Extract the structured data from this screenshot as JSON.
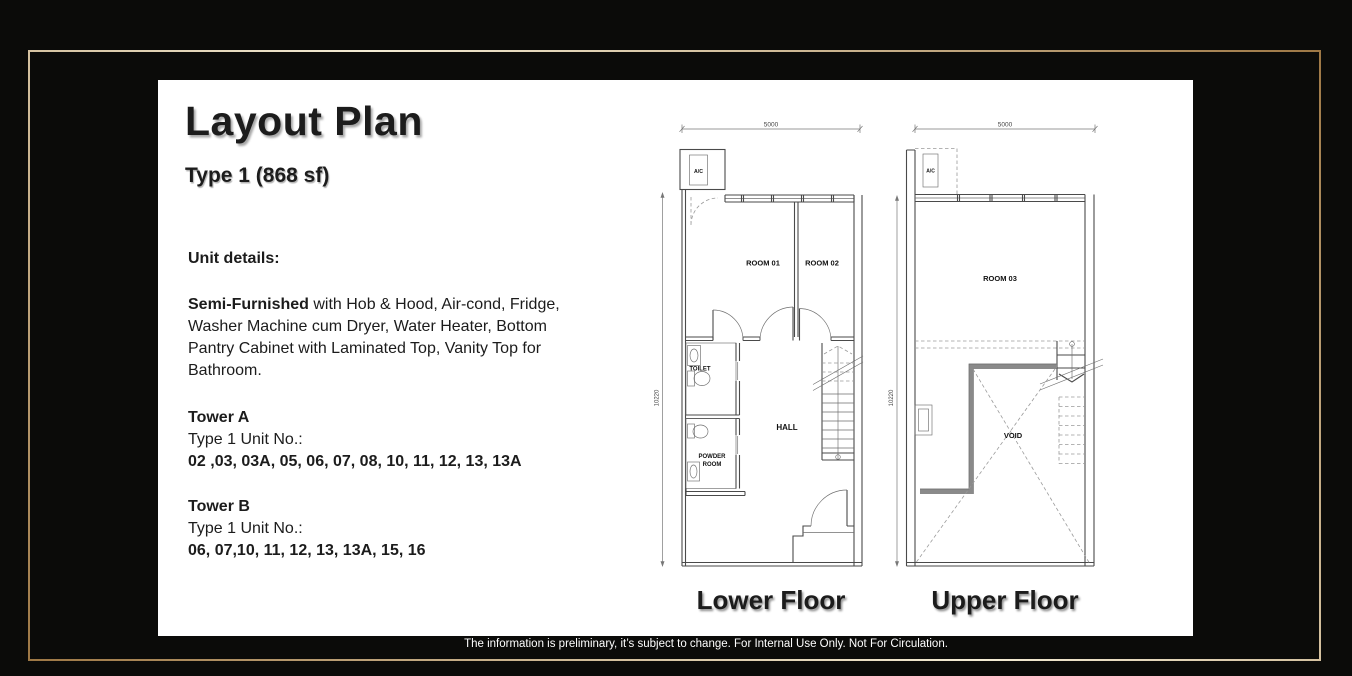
{
  "slide": {
    "title": "Layout Plan",
    "subtitle": "Type 1 (868 sf)",
    "unit_details_heading": "Unit details:",
    "details": {
      "lead": "Semi-Furnished",
      "rest": " with Hob & Hood, Air-cond, Fridge,\nWasher Machine cum Dryer, Water Heater, Bottom\nPantry Cabinet with Laminated Top, Vanity Top for\nBathroom."
    },
    "towers": [
      {
        "name": "Tower A",
        "type_label": "Type 1 Unit No.:",
        "units": "02 ,03, 03A, 05, 06, 07, 08, 10, 11, 12, 13, 13A"
      },
      {
        "name": "Tower B",
        "type_label": "Type 1 Unit No.:",
        "units": "06, 07,10, 11, 12, 13, 13A, 15, 16"
      }
    ],
    "plans": {
      "lower": {
        "caption": "Lower Floor",
        "dim_width": "5000",
        "dim_height": "10220",
        "ac": "A/C",
        "room01": "ROOM 01",
        "room02": "ROOM 02",
        "toilet": "TOILET",
        "hall": "HALL",
        "powder_line1": "POWDER",
        "powder_line2": "ROOM"
      },
      "upper": {
        "caption": "Upper Floor",
        "dim_width": "5000",
        "dim_height": "10220",
        "ac": "A/C",
        "room03": "ROOM 03",
        "void": "VOID"
      }
    },
    "disclaimer": "The information is preliminary, it’s subject to change. For Internal Use Only. Not For Circulation."
  },
  "colors": {
    "background": "#0b0b09",
    "frame_gold": "#c9a063",
    "frame_light": "#f4ecd4",
    "frame_dark": "#9e7845",
    "panel": "#ffffff",
    "text": "#1c1c1c"
  }
}
